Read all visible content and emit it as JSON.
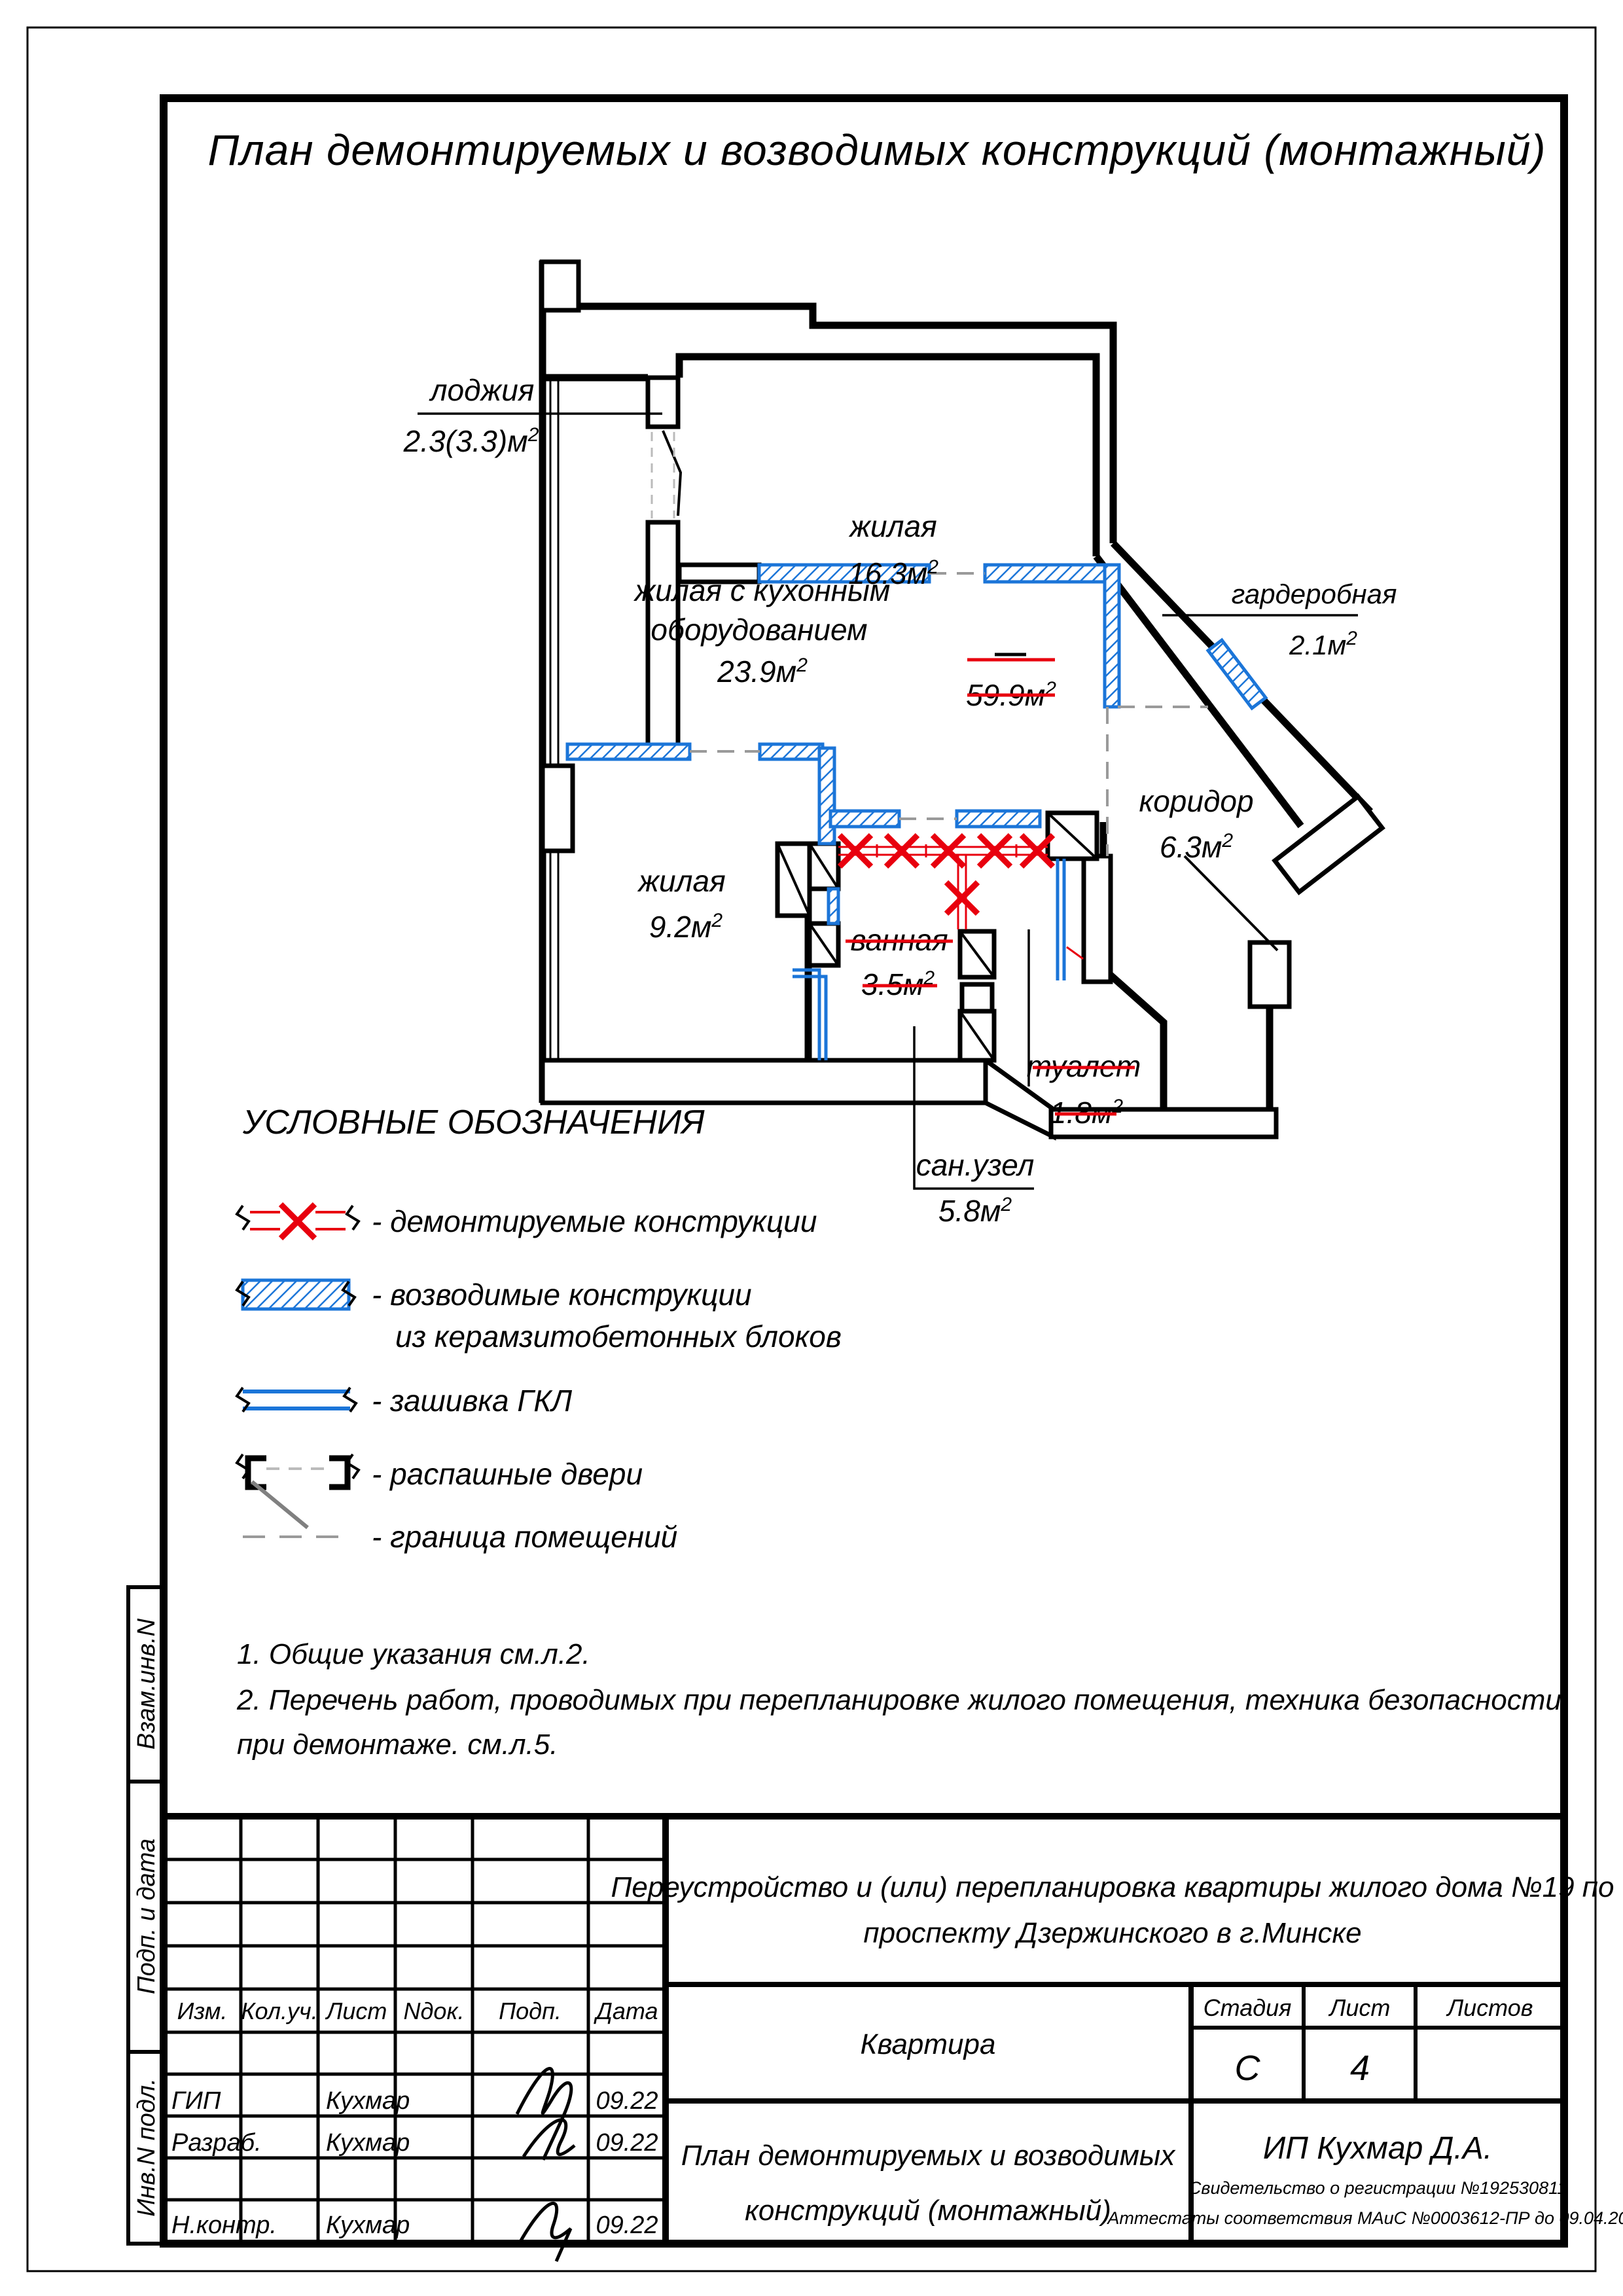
{
  "title": "План  демонтируемых  и  возводимых  конструкций  (монтажный)",
  "sup": "2",
  "rooms": {
    "loggia": {
      "name": "лоджия",
      "area": "2.3(3.3)м"
    },
    "living_top": {
      "name": "жилая",
      "area": "16.3м"
    },
    "kitchen": {
      "line1": "жилая с кухонным",
      "line2": "оборудованием",
      "area": "23.9м"
    },
    "wardrobe": {
      "name": "гардеробная",
      "area": "2.1м"
    },
    "corridor": {
      "name": "коридор",
      "area": "6.3м"
    },
    "living_small": {
      "name": "жилая",
      "area": "9.2м"
    },
    "bath": {
      "name": "ванная",
      "area": "3.5м"
    },
    "wc": {
      "name": "туалет",
      "area": "1.8м"
    },
    "sanunit": {
      "name": "сан.узел",
      "area": "5.8м"
    },
    "total_struck": "59.9м"
  },
  "legend": {
    "title": "УСЛОВНЫЕ ОБОЗНАЧЕНИЯ",
    "demolished": "- демонтируемые конструкции",
    "erected_1": "- возводимые конструкции",
    "erected_2": "из керамзитобетонных блоков",
    "gkl": "- зашивка ГКЛ",
    "doors": "- распашные двери",
    "boundary": "- граница помещений"
  },
  "notes": {
    "n1": "1. Общие указания см.л.2.",
    "n2": "2. Перечень работ, проводимых при перепланировке жилого помещения, техника безопасности",
    "n3": "при демонтаже. см.л.5."
  },
  "titleblock": {
    "col_izm": "Изм.",
    "col_koluch": "Кол.уч.",
    "col_list": "Лист",
    "col_ndok": "Nдок.",
    "col_podp": "Подп.",
    "col_data": "Дата",
    "row_gip": "ГИП",
    "row_razrab": "Разраб.",
    "row_nkontr": "Н.контр.",
    "surname": "Кухмар",
    "date": "09.22",
    "project_1": "Переустройство и (или) перепланировка квартиры жилого дома №19 по",
    "project_2": "проспекту Дзержинского в г.Минске",
    "object": "Квартира",
    "stage_label": "Стадия",
    "sheet_label": "Лист",
    "sheets_label": "Листов",
    "stage": "С",
    "sheet": "4",
    "doc_1": "План демонтируемых и возводимых",
    "doc_2": "конструкций (монтажный)",
    "company": "ИП Кухмар Д.А.",
    "cert_1": "Свидетельство о регистрации №192530811",
    "cert_2": "Аттестаты соответствия МАиС №0003612-ПР до 09.04.2026"
  },
  "side": {
    "zam": "Взам.инв.N",
    "podp": "Подп. и дата",
    "inv": "Инв.N подл."
  },
  "colors": {
    "new_wall_blue": "#1b75d8",
    "demolition_red": "#e8000e",
    "boundary_gray": "#9a9a9a"
  }
}
